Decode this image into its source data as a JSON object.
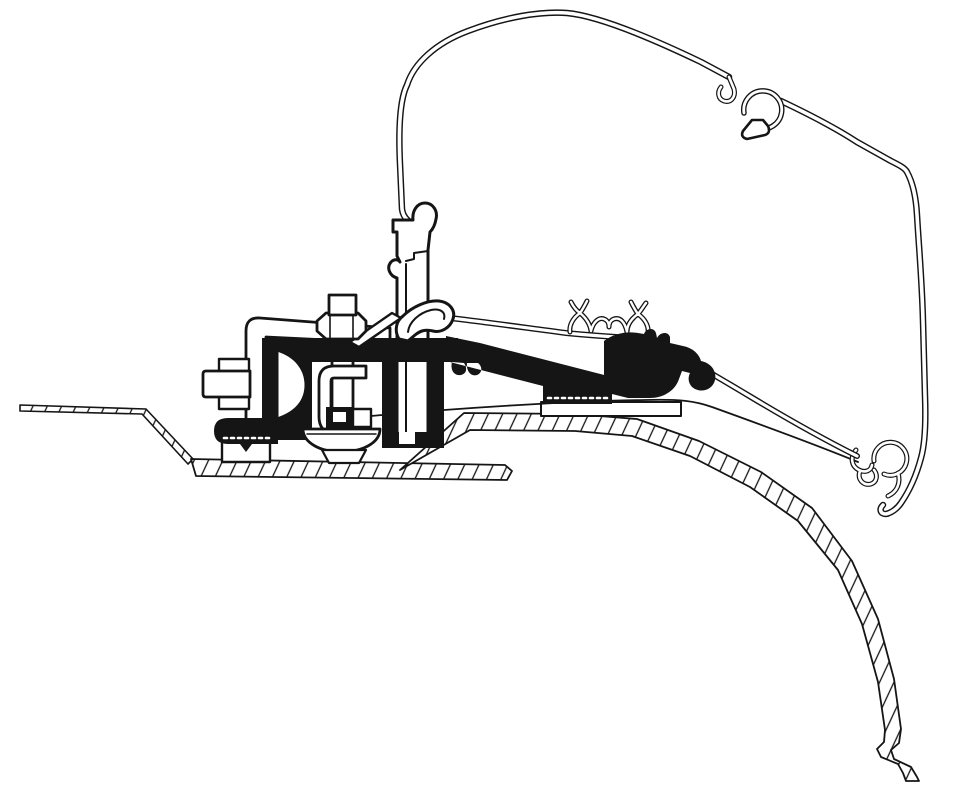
{
  "canvas": {
    "width": 959,
    "height": 800,
    "background": "#ffffff",
    "ink": "#151515",
    "paper": "#ffffff"
  },
  "diagram": {
    "hatch": {
      "size": 13,
      "angle": 25,
      "line_width": 1.3
    },
    "shapes": [
      {
        "name": "roof-sheet-left-thin",
        "kind": "outline",
        "fill": "hatch",
        "sw": 1.6,
        "d": "M 20,405 L 146,409 L 193,459 L 188,464 L 142,414 L 20,411 Z"
      },
      {
        "name": "roof-band-left",
        "kind": "outline",
        "fill": "hatch",
        "sw": 1.8,
        "d": "M 191,459 L 505,465 L 512,471 L 507,480 L 196,476 Z"
      },
      {
        "name": "roof-band-main",
        "kind": "outline",
        "fill": "hatch",
        "sw": 1.8,
        "d": "M 400,470 L 464,413 L 575,414 L 637,419 L 699,441 L 761,472 L 812,508 L 852,561 L 878,619 L 894,679 L 901,729 L 899,743 L 891,750 L 894,759 L 911,767 L 917,777 L 919,781 L 906,781 L 903,773 L 898,764 L 881,757 L 877,749 L 884,742 L 885,730 L 878,682 L 862,624 L 838,570 L 798,521 L 750,487 L 690,456 L 632,436 L 575,431 L 470,430 Z"
      },
      {
        "name": "roof-mounting-plate",
        "kind": "outline",
        "sw": 2,
        "d": "M 541,402 L 681,402 L 681,416 L 541,416 Z"
      },
      {
        "name": "awning-case-outline",
        "kind": "double",
        "sw": 6.5,
        "sw2": 3.6,
        "d": "M 425,242 C 429,236 428,229 421,227 C 410,224 403,218 402,209 L 400,164 C 398,121 401,97 407,85 C 414,63 436,43 468,31 C 505,17 541,11 567,13 C 599,16 651,38 701,62 L 729,77 M 781,101 C 800,110 831,125 857,142 L 891,161 C 899,165 905,168 907,172 C 913,183 916,197 917,215 C 919,249 922,281 923,321 L 925,396 C 926,424 925,444 921,458 C 917,473 910,490 901,503 C 897,509 891,513 886,514 C 880,514 879,509 883,505"
      },
      {
        "name": "case-clip-stub",
        "kind": "double",
        "sw": 5,
        "sw2": 2.6,
        "d": "M 729,77 L 734,89 C 736,97 731,103 724,101 C 718,99 717,92 721,87"
      },
      {
        "name": "case-top-clip-ring",
        "kind": "double",
        "sw": 5.5,
        "sw2": 2.8,
        "d": "M 744,113 A 19 19 0 1 1 757,128"
      },
      {
        "name": "case-top-clip-foot",
        "kind": "outline",
        "sw": 2.6,
        "d": "M 752,120 L 743,131 Q 740,137 747,139 L 765,135 Q 771,133 768,126 L 763,120 Z"
      },
      {
        "name": "rail-lower-strip",
        "kind": "line",
        "sw": 1.8,
        "d": "M 371,416 C 460,408 570,401 645,400 C 680,399 695,401 712,407 C 762,425 824,448 858,462"
      },
      {
        "name": "rail-end-clip",
        "kind": "double",
        "sw": 5,
        "sw2": 2.6,
        "d": "M 874,461 A 16.5 16.5 0 1 1 884,474 M 856,450 C 850,457 851,466 859,470 C 865,473 871,471 872,465 M 860,471 C 857,479 863,486 871,484 C 877,482 878,475 874,470 M 898,473 C 901,483 897,492 888,496"
      },
      {
        "name": "mount-rail-profile",
        "kind": "outline",
        "sw": 3,
        "d": "M 393,220 L 413,220 C 412,211 417,203 425,203 C 433,203 438,211 436,219 C 435,225 433,229 430,232 L 428,250 L 428,438 Q 428,444 420,444 L 404,444 Q 397,444 397,438 L 397,278 C 390,276 386,268 391,262 C 394,259 398,259 400,262 L 397,256 L 397,232 L 393,232 Z"
      },
      {
        "name": "mount-rail-profile-step",
        "kind": "line",
        "sw": 2,
        "d": "M 428,251 L 414,253 L 414,259 L 406,261 M 406,264 L 406,436"
      },
      {
        "name": "awning-rail",
        "kind": "double",
        "sw": 6,
        "sw2": 3.2,
        "d": "M 441,317 C 470,320 520,327 566,333 C 586,335 601,336 616,337 C 641,339 656,343 671,351 C 691,361 721,379 751,397 C 791,421 831,443 857,456"
      },
      {
        "name": "rail-crown-profile",
        "kind": "double",
        "sw": 5,
        "sw2": 2.4,
        "d": "M 571,302 C 574,308 577,311 580,313 C 583,309 585,305 587,301 M 580,313 C 573,318 569,325 570,332 M 580,313 C 586,318 590,324 591,331 M 591,331 C 593,322 599,317 604,319 C 607,320 609,323 609,327 M 609,327 C 609,323 611,320 614,319 C 620,317 625,322 627,332 M 638,314 C 631,319 627,325 627,332 M 638,314 C 645,319 649,326 648,333 M 631,302 C 633,306 635,310 638,314 C 640,312 643,307 646,303"
      },
      {
        "name": "clamp-bracket",
        "kind": "outline",
        "sw": 2.8,
        "d": "M 246,420 L 246,331 Q 246,317 260,318 L 390,328 L 390,343 L 266,337 L 266,420 Z"
      },
      {
        "name": "side-bolt-collars",
        "kind": "outline",
        "sw": 2.4,
        "d": "M 219,359 L 249,359 L 249,372 L 219,372 Z M 219,396 L 249,396 L 249,409 L 219,409 Z"
      },
      {
        "name": "side-bolt-head",
        "kind": "outline",
        "sw": 2.8,
        "d": "M 206,371 Q 203,371 203,374 L 203,394 Q 203,397 206,397 L 250,397 L 250,371 Z"
      },
      {
        "name": "clamp-foot-block",
        "kind": "outline",
        "sw": 2.4,
        "d": "M 222,442 L 270,442 L 270,462 L 222,462 Z"
      },
      {
        "name": "center-bolt-rod",
        "kind": "outline",
        "sw": 2.8,
        "d": "M 332,316 L 353,316 L 353,412 L 332,412 Z"
      },
      {
        "name": "adapter-profile",
        "kind": "solid",
        "fill": "ink",
        "d": "M 262,338 L 312,338 L 312,440 L 262,440 Z M 228,418 L 278,418 L 278,444 L 252,444 L 246,452 L 240,444 L 228,444 Q 214,444 214,431 Q 214,418 228,418 Z M 262,338 L 458,338 L 458,362 L 262,362 Z M 446,336 L 480,343 L 612,377 L 612,404 L 543,404 L 543,386 L 446,361 Z M 604,392 L 604,341 C 613,334 626,331 638,333 L 644,334 C 646,328 654,327 656,333 L 657,338 C 660,332 668,331 670,337 L 670,343 L 683,346 C 693,348 699,354 701,361 C 711,363 717,371 715,380 C 713,389 703,393 695,389 C 689,386 687,379 690,373 L 682,371 L 679,379 C 675,391 663,398 650,398 L 628,398 Z M 452,362 C 450,370 454,376 461,375 C 466,374 468,369 464,363 Z M 467,363 C 466,371 471,377 477,375 C 482,373 483,367 478,363 Z M 382,360 L 396,360 L 396,434 L 382,434 Z M 428,358 L 444,358 L 444,434 L 428,434 Z M 382,432 L 444,432 L 444,448 L 382,448 Z"
      },
      {
        "name": "adapter-channel-notch",
        "kind": "solid",
        "fill": "white",
        "d": "M 399,432 L 415,432 L 415,444 L 399,444 Z"
      },
      {
        "name": "adapter-serrations",
        "kind": "line",
        "stroke": "white",
        "sw": 2.6,
        "dash": "3 4",
        "d": "M 224,438 L 272,438 M 548,398 L 608,398"
      },
      {
        "name": "spacer-washer",
        "kind": "outline",
        "sw": 3,
        "d": "M 277,350 C 296,356 306,369 306,385 C 306,401 296,413 277,419 Z"
      },
      {
        "name": "rail-hook-profile",
        "kind": "outline",
        "sw": 3,
        "d": "M 399,339 C 394,331 396,321 403,316 C 412,307 427,300 439,301 C 449,302 456,310 453,319 C 450,328 441,333 433,331 C 425,329 420,331 415,335 L 408,341 Z"
      },
      {
        "name": "rail-hook-inner",
        "kind": "line",
        "sw": 2,
        "d": "M 408,332 C 409,322 419,313 431,310 C 440,308 446,312 444,319"
      },
      {
        "name": "support-strut",
        "kind": "outline",
        "sw": 2.4,
        "d": "M 350,342 L 392,313 L 401,318 L 359,347 Z"
      },
      {
        "name": "center-bolt-nut",
        "kind": "outline",
        "sw": 2.8,
        "d": "M 317,321 L 326,313 L 358,313 L 366,321 L 366,331 L 358,339 L 326,339 L 317,331 Z"
      },
      {
        "name": "nut-facets",
        "kind": "line",
        "sw": 1.6,
        "d": "M 330,313 L 330,339 M 353,313 L 353,339"
      },
      {
        "name": "center-bolt-head",
        "kind": "outline",
        "sw": 2.8,
        "d": "M 329,295 L 356,295 L 356,315 L 329,315 Z"
      },
      {
        "name": "clamp-channel",
        "kind": "outline",
        "sw": 2.8,
        "d": "M 366,366 L 334,366 Q 319,366 319,381 L 319,417 Q 319,431 333,435 L 367,442 L 367,429 L 342,424 Q 331,422 331,413 L 331,381 Q 331,378 334,378 L 366,378 Z"
      },
      {
        "name": "rod-end-block",
        "kind": "solid",
        "fill": "ink",
        "d": "M 326,407 L 353,407 L 353,428 L 326,428 Z"
      },
      {
        "name": "rod-end-core",
        "kind": "outline",
        "sw": 2,
        "d": "M 332,411 L 347,411 L 347,423 L 332,423 Z"
      },
      {
        "name": "rod-side-block",
        "kind": "outline",
        "sw": 2.4,
        "d": "M 353,409 L 371,409 L 371,427 L 353,427 Z"
      },
      {
        "name": "pressure-dish",
        "kind": "outline",
        "sw": 2.8,
        "d": "M 303,429 L 380,429 C 380,443 362,452 341,452 C 321,452 303,443 303,429 Z"
      },
      {
        "name": "pressure-dish-line",
        "kind": "line",
        "sw": 1.5,
        "d": "M 307,434 L 376,434"
      },
      {
        "name": "pressure-pad",
        "kind": "outline",
        "sw": 2.2,
        "d": "M 322,450 L 366,450 L 359,463 L 329,463 Z"
      }
    ]
  }
}
